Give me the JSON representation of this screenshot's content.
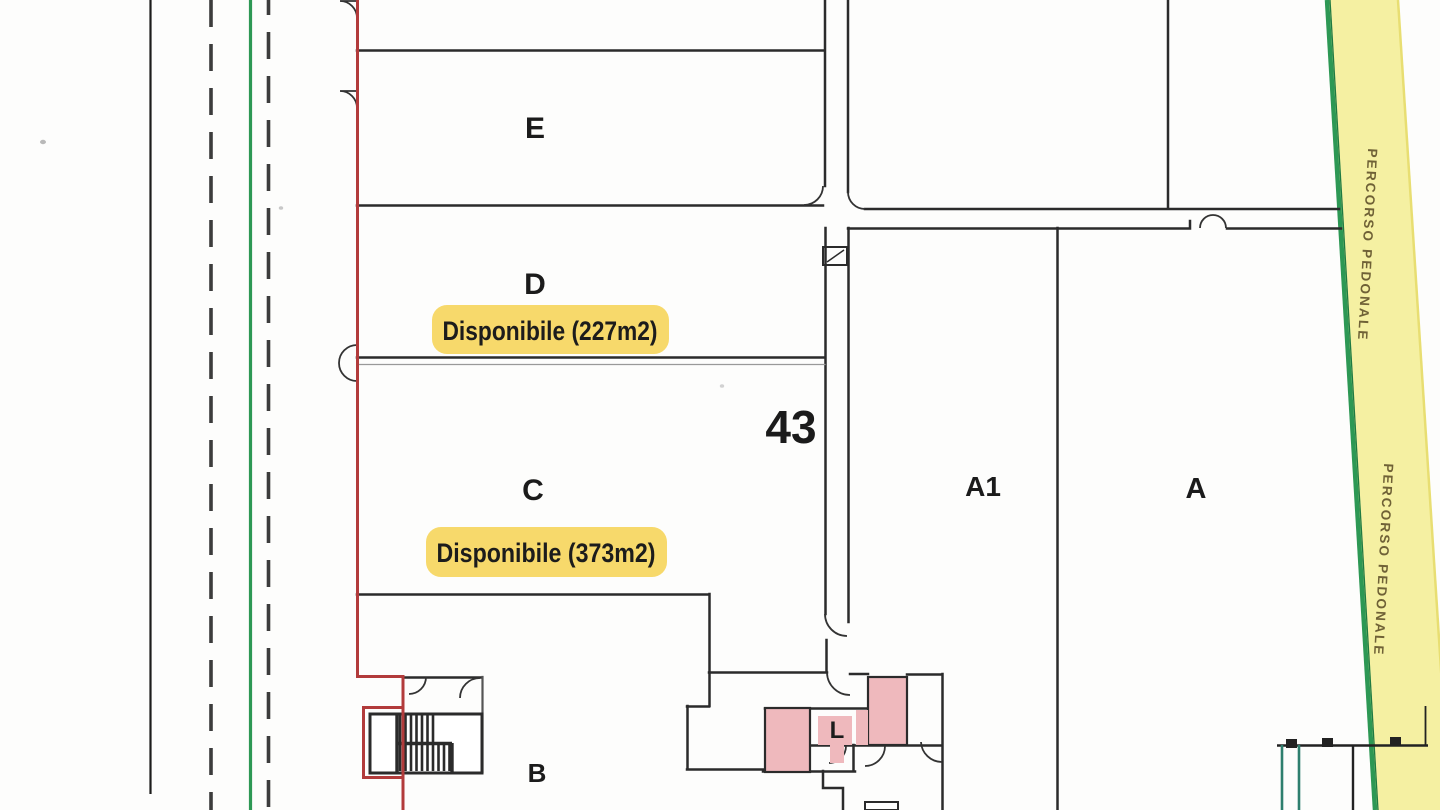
{
  "plan": {
    "street_number": "43",
    "pedestrian_path_label": "PERCORSO PEDONALE",
    "rooms": {
      "e": {
        "label": "E"
      },
      "d": {
        "label": "D",
        "availability": "Disponibile (227m2)"
      },
      "c": {
        "label": "C",
        "availability": "Disponibile (373m2)"
      },
      "b": {
        "label": "B"
      },
      "a1": {
        "label": "A1"
      },
      "a": {
        "label": "A"
      },
      "l": {
        "label": "L"
      }
    },
    "colors": {
      "wall": "#2b2b2b",
      "boundary_red": "#b23b3b",
      "path_green": "#2d9854",
      "path_yellow": "#f5f0a2",
      "highlight_yellow": "#f7d96b",
      "room_pink": "#efb9bd"
    }
  }
}
